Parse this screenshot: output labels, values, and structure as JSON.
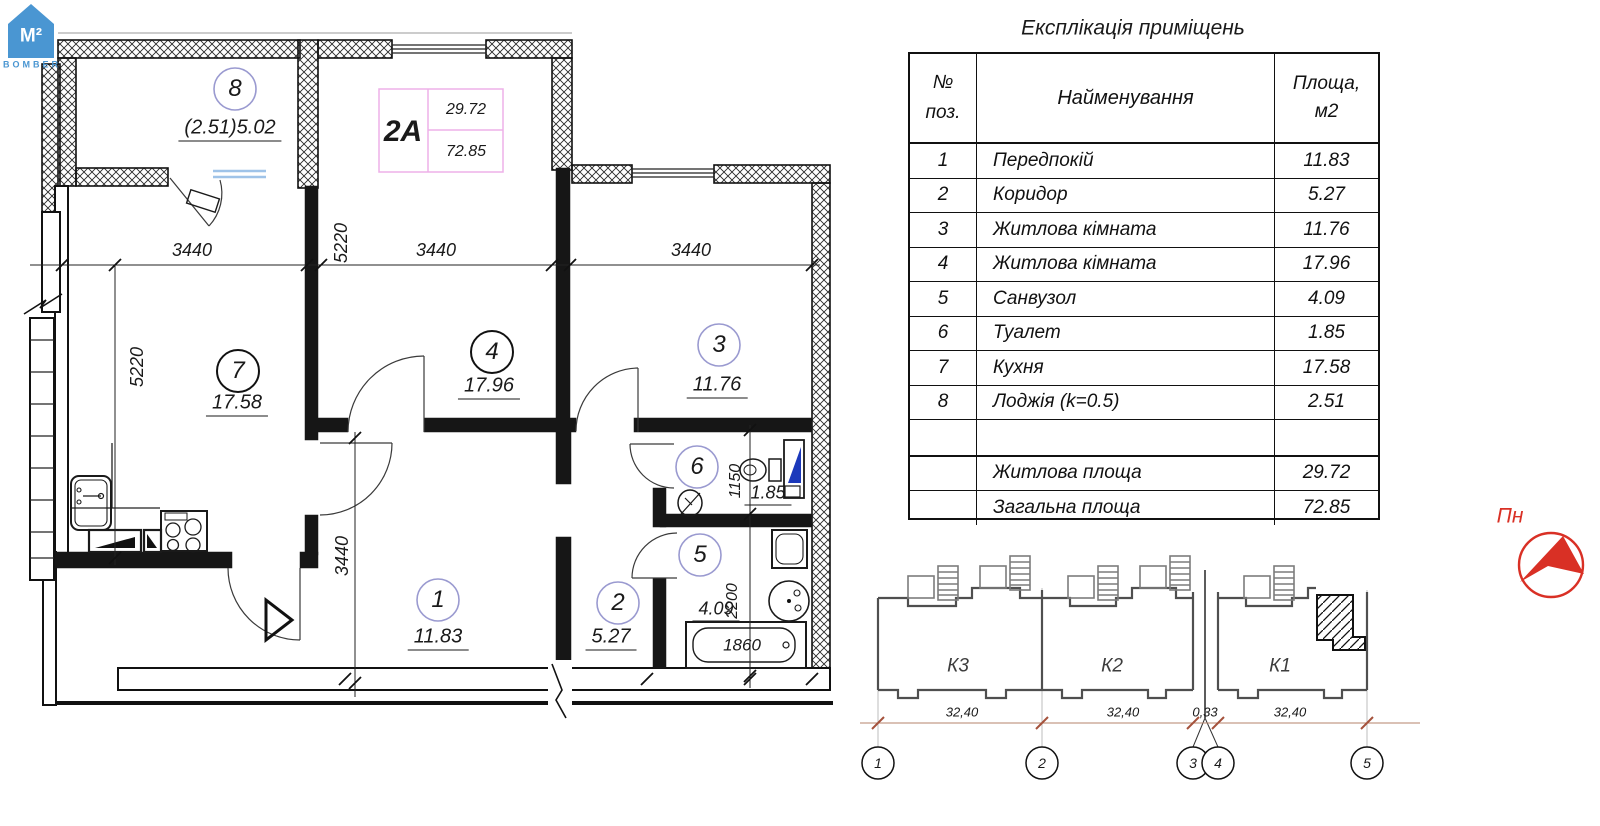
{
  "logo": {
    "mark": "M²",
    "word": "BOMBER"
  },
  "exp_table": {
    "title": "Експлікація приміщень",
    "col_num_l1": "№",
    "col_num_l2": "поз.",
    "col_name": "Найменування",
    "col_area_l1": "Площа,",
    "col_area_l2": "м2",
    "rows": [
      {
        "num": "1",
        "name": "Передпокій",
        "area": "11.83"
      },
      {
        "num": "2",
        "name": "Коридор",
        "area": "5.27"
      },
      {
        "num": "3",
        "name": "Житлова кімната",
        "area": "11.76"
      },
      {
        "num": "4",
        "name": "Житлова кімната",
        "area": "17.96"
      },
      {
        "num": "5",
        "name": "Санвузол",
        "area": "4.09"
      },
      {
        "num": "6",
        "name": "Туалет",
        "area": "1.85"
      },
      {
        "num": "7",
        "name": "Кухня",
        "area": "17.58"
      },
      {
        "num": "8",
        "name": "Лоджія (k=0.5)",
        "area": "2.51"
      },
      {
        "num": "",
        "name": "",
        "area": ""
      },
      {
        "num": "",
        "name": "Житлова площа",
        "area": "29.72"
      },
      {
        "num": "",
        "name": "Загальна площа",
        "area": "72.85"
      }
    ]
  },
  "plan": {
    "unit": {
      "code": "2А",
      "living_area": "29.72",
      "total_area": "72.85"
    },
    "rooms": {
      "r1": {
        "num": "1",
        "area": "11.83"
      },
      "r2": {
        "num": "2",
        "area": "5.27"
      },
      "r3": {
        "num": "3",
        "area": "11.76"
      },
      "r4": {
        "num": "4",
        "area": "17.96"
      },
      "r5": {
        "num": "5",
        "area": "4.09"
      },
      "r6": {
        "num": "6",
        "area": "1.85"
      },
      "r7": {
        "num": "7",
        "area": "17.58"
      },
      "r8": {
        "num": "8",
        "area": "(2.51)5.02"
      }
    },
    "dims": {
      "w_kitchen": "3440",
      "w_room4": "3440",
      "w_room3": "3440",
      "depth_top": "5220",
      "depth_left": "5220",
      "hall_depth": "3440",
      "wc_depth": "1150",
      "bath_depth": "2200",
      "tub_len": "1860"
    }
  },
  "site": {
    "sections": {
      "k3": "К3",
      "k2": "К2",
      "k1": "К1"
    },
    "dims": {
      "d1": "32,40",
      "d2": "32,40",
      "d3": "0,33",
      "d4": "32,40"
    },
    "axes": {
      "a1": "1",
      "a2": "2",
      "a3": "3",
      "a4": "4",
      "a5": "5"
    }
  },
  "north": {
    "label": "Пн"
  },
  "colors": {
    "logo_blue": "#4a96d2",
    "north_red": "#d93025",
    "circle_lavender": "#9a9ad0",
    "unit_frame_pink": "#eeb0e8",
    "window_blue": "#9fc3e8"
  }
}
